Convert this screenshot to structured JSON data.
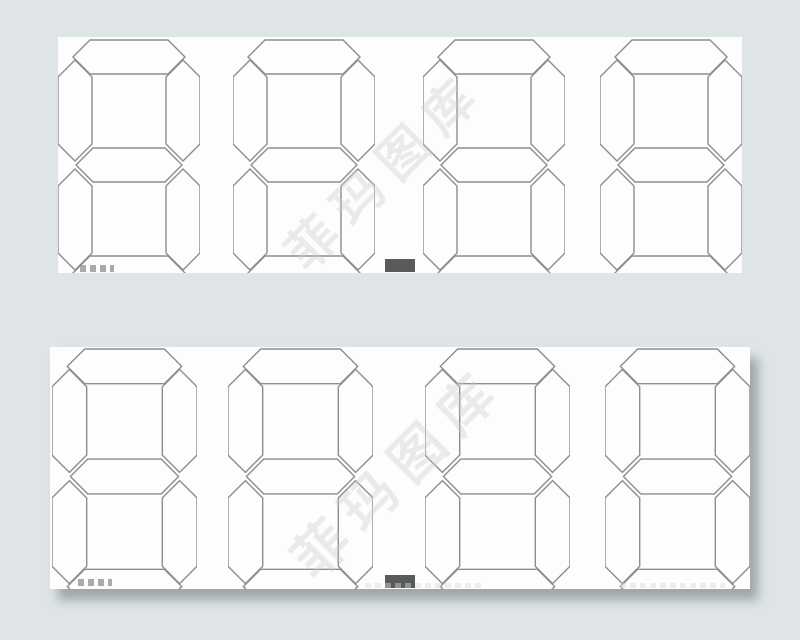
{
  "figure": {
    "type": "seven-segment-display-graphic",
    "background_color": "#dfe5e7",
    "panel_color": "#fdfdfd",
    "segment_outline_color": "#8d8d8d",
    "segment_fill": "none",
    "decimal_point_color": "#595a5c",
    "segment_state": "unlit_outline",
    "segments_per_digit": [
      "a",
      "b",
      "c",
      "d",
      "e",
      "f",
      "g"
    ],
    "watermark": {
      "text": "菲玛图库",
      "color": "#cdcdcd"
    },
    "panels": [
      {
        "id": "top",
        "x": 58,
        "y": 37,
        "width": 684,
        "height": 236,
        "digits": [
          "8",
          "8",
          "8",
          "8"
        ],
        "decimal_point_after_digit": 2,
        "digit_width": 142,
        "digit_height": 252,
        "digit_top": 2,
        "digit_x": [
          0,
          175,
          365,
          542
        ],
        "decimal_point": {
          "x": 327,
          "y": 222,
          "width": 30,
          "height": 13
        },
        "watermark_center": {
          "x": 325,
          "y": 131
        },
        "watermark_font_size": 50,
        "watermark_letter_spacing": 14,
        "shadow": false,
        "edge_marks": [
          {
            "x": 22,
            "y": 228,
            "w": 34,
            "h": 7,
            "color": "#8f8f8f",
            "faint": false
          }
        ]
      },
      {
        "id": "bottom",
        "x": 50,
        "y": 347,
        "width": 700,
        "height": 242,
        "digits": [
          "8",
          "8",
          "8",
          "8"
        ],
        "decimal_point_after_digit": 2,
        "digit_width": 145,
        "digit_height": 257,
        "digit_top": 1,
        "digit_x": [
          2,
          178,
          375,
          555
        ],
        "decimal_point": {
          "x": 335,
          "y": 228,
          "width": 30,
          "height": 13
        },
        "watermark_center": {
          "x": 345,
          "y": 122
        },
        "watermark_font_size": 54,
        "watermark_letter_spacing": 14,
        "shadow": true,
        "edge_marks": [
          {
            "x": 28,
            "y": 232,
            "w": 34,
            "h": 7,
            "color": "#8f8f8f",
            "faint": false
          },
          {
            "x": 315,
            "y": 236,
            "w": 120,
            "h": 5,
            "color": "#d9d9d9",
            "faint": true
          },
          {
            "x": 570,
            "y": 236,
            "w": 105,
            "h": 5,
            "color": "#d9d9d9",
            "faint": true
          }
        ]
      }
    ]
  }
}
